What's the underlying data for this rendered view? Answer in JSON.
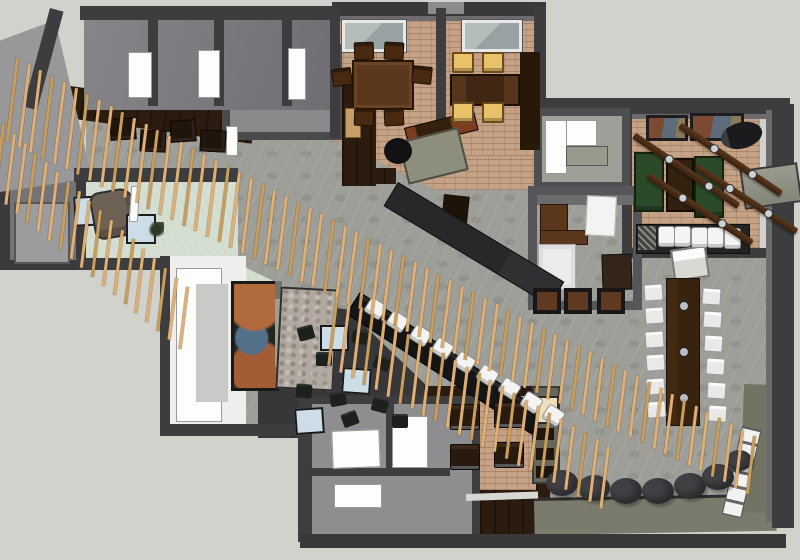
{
  "scene": {
    "type": "3d-floorplan-render",
    "view": "top-down"
  },
  "palette": {
    "bg": "#d2d2cc",
    "wall": "#3d3d3f",
    "wall_mid": "#6c6c6e",
    "wall_face": "#98989a",
    "tile": "#9e9e99",
    "brick": "#c5a285",
    "mint": "#d5dfd1",
    "lounge": "#37373a",
    "wood_dark": "#2c1c10",
    "wood_table": "#5a371d",
    "slat": "#dfb076",
    "slat_dark": "#c99e5d",
    "seat_white": "#f3f3f1",
    "seat_lit": "#e8c168",
    "green": "#2a4a29",
    "beam": "#4b2c17",
    "ottoman": "#2b2b2d",
    "blue_table": "#cddde8",
    "olive": "#7b7b6d",
    "corridor": "#eeeeec",
    "stone": "#b1a89f"
  },
  "generated": [
    {
      "name": "ottoman",
      "cls": "ottoman",
      "mode": "list",
      "w": 32,
      "h": 26,
      "items": [
        [
          546,
          470
        ],
        [
          578,
          475
        ],
        [
          610,
          478
        ],
        [
          642,
          478
        ],
        [
          674,
          473
        ],
        [
          702,
          464
        ],
        [
          726,
          450,
          0,
          26,
          21
        ]
      ]
    },
    {
      "name": "booth-chair",
      "cls": "chair-booth",
      "mode": "list",
      "w": 28,
      "h": 24,
      "items": [
        [
          450,
          404
        ],
        [
          494,
          402
        ],
        [
          450,
          444
        ],
        [
          494,
          442
        ]
      ]
    },
    {
      "name": "lounge-chair",
      "cls": "chair-dark",
      "mode": "list",
      "w": 16,
      "h": 14,
      "items": [
        [
          298,
          326,
          -15
        ],
        [
          352,
          330,
          10
        ],
        [
          316,
          352,
          0
        ],
        [
          374,
          356,
          20
        ],
        [
          330,
          392,
          -10
        ],
        [
          372,
          398,
          15
        ],
        [
          296,
          384,
          5
        ],
        [
          392,
          414,
          0
        ],
        [
          342,
          412,
          -20
        ]
      ]
    },
    {
      "name": "dining1-chair",
      "cls": "chair-wood",
      "mode": "list",
      "w": 18,
      "h": 16,
      "items": [
        [
          354,
          42,
          -2
        ],
        [
          384,
          42,
          3
        ],
        [
          354,
          108,
          2
        ],
        [
          384,
          108,
          -3
        ],
        [
          332,
          68,
          -8
        ],
        [
          412,
          66,
          6
        ]
      ]
    },
    {
      "name": "dining2-chair",
      "cls": "chair-lit",
      "mode": "list",
      "w": 18,
      "h": 17,
      "items": [
        [
          452,
          52
        ],
        [
          482,
          52
        ],
        [
          452,
          102
        ],
        [
          482,
          102
        ]
      ]
    },
    {
      "name": "servery-table",
      "cls": "table-mini",
      "mode": "list",
      "w": 24,
      "h": 20,
      "items": [
        [
          110,
          118,
          -4
        ],
        [
          140,
          130,
          3
        ],
        [
          170,
          120,
          -4
        ],
        [
          200,
          130,
          3
        ]
      ]
    },
    {
      "name": "office-stool",
      "cls": "stool-dark",
      "mode": "list",
      "w": 20,
      "h": 18,
      "items": [
        [
          533,
          288
        ],
        [
          564,
          288
        ],
        [
          597,
          288
        ]
      ]
    },
    {
      "name": "communal-chair-left",
      "cls": "chair-white",
      "mode": "line",
      "count": 6,
      "x": 644,
      "y": 284,
      "dx": 0.6,
      "dy": 23.4,
      "w": 17,
      "h": 15,
      "rot": -4
    },
    {
      "name": "communal-chair-right",
      "cls": "chair-white",
      "mode": "line",
      "count": 6,
      "x": 702,
      "y": 288,
      "dx": 1.2,
      "dy": 23.4,
      "w": 17,
      "h": 15,
      "rot": 4
    },
    {
      "name": "center-bar-stool",
      "cls": "stool-white",
      "mode": "line",
      "count": 9,
      "x": 366,
      "y": 300,
      "dx": 22.3,
      "dy": 13.4,
      "w": 17,
      "h": 15,
      "rot": 33
    },
    {
      "name": "bar-room-stool",
      "cls": "stool-white",
      "mode": "line",
      "count": 5,
      "x": 658,
      "y": 226,
      "dx": 16.4,
      "dy": 0.4,
      "w": 15,
      "h": 19,
      "rot": 0
    },
    {
      "name": "ceiling-beam",
      "cls": "beam",
      "mode": "list",
      "w": 124,
      "h": 7,
      "dots": [
        0.3,
        0.68
      ],
      "items": [
        [
          634,
          132,
          34,
          126
        ],
        [
          680,
          122,
          34,
          122
        ],
        [
          648,
          172,
          33,
          124
        ],
        [
          696,
          163,
          33,
          120
        ]
      ]
    },
    {
      "name": "slat-screen-left",
      "cls": "slat",
      "mode": "line",
      "count": 18,
      "x": 2,
      "y": 124,
      "dx": 10.8,
      "dy": 9.6,
      "w": 3,
      "h0": 72,
      "dh": -0.6,
      "rot": 7,
      "altEvery": 3
    },
    {
      "name": "slat-screen-bar",
      "cls": "slat",
      "mode": "line",
      "count": 24,
      "x": 336,
      "y": 294,
      "dx": 11.8,
      "dy": 6.6,
      "w": 3,
      "h0": 72,
      "dh": -0.4,
      "rot": 7,
      "altEvery": 3
    },
    {
      "name": "slat-screen-main",
      "cls": "slat",
      "mode": "line",
      "count": 64,
      "x": 16,
      "y": 58,
      "dx": 11.7,
      "dy": 6.0,
      "w": 3,
      "h0": 84,
      "dh": -0.42,
      "rot": 7,
      "altEvery": 3
    }
  ]
}
